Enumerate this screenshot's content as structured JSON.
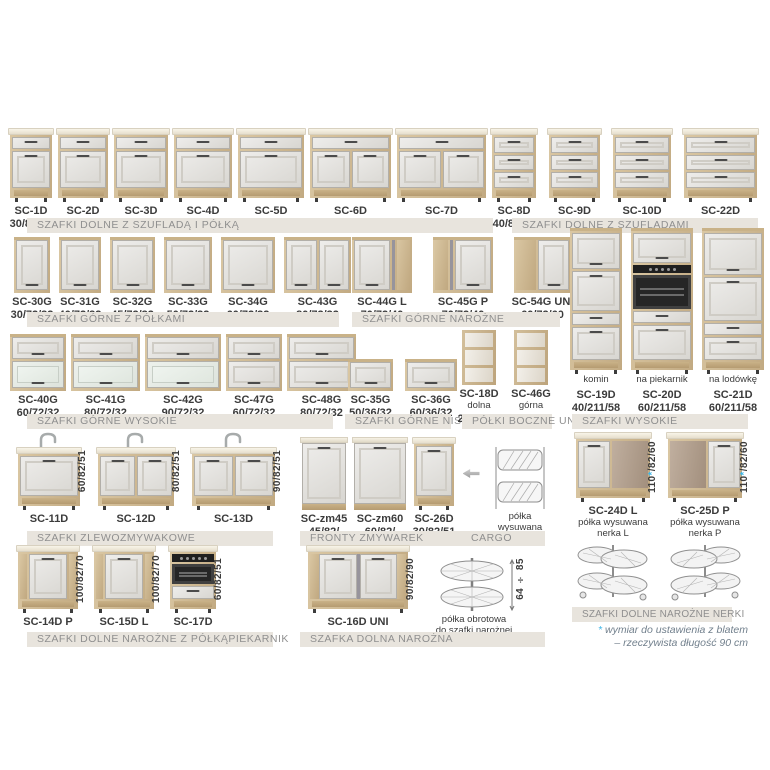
{
  "accent_color": "#3bb6e8",
  "band_bg_color": "#e8e4dd",
  "groups": [
    {
      "id": "g1",
      "band": "SZAFKI DOLNE Z SZUFLADĄ I PÓŁKĄ",
      "items": [
        {
          "code": "SC-1D",
          "dims": "30/82/51",
          "type": "base-d1"
        },
        {
          "code": "SC-2D",
          "dims": "40/82/51",
          "type": "base-d1"
        },
        {
          "code": "SC-3D",
          "dims": "45/82/51",
          "type": "base-d1"
        },
        {
          "code": "SC-4D",
          "dims": "50/82/51",
          "type": "base-d1"
        },
        {
          "code": "SC-5D",
          "dims": "60/82/51",
          "type": "base-d1"
        },
        {
          "code": "SC-6D",
          "dims": "80/82/51",
          "type": "base-d2"
        },
        {
          "code": "SC-7D",
          "dims": "90/82/51",
          "type": "base-d2"
        }
      ]
    },
    {
      "id": "g2",
      "band": "SZAFKI DOLNE Z SZUFLADAMI",
      "items": [
        {
          "code": "SC-8D",
          "dims": "40/82/51",
          "type": "base-dr3"
        },
        {
          "code": "SC-9D",
          "dims": "50/82/51",
          "type": "base-dr3"
        },
        {
          "code": "SC-10D",
          "dims": "60/82/51",
          "type": "base-dr3"
        },
        {
          "code": "SC-22D",
          "dims": "80/82/51",
          "type": "base-dr3"
        }
      ]
    },
    {
      "id": "g3",
      "band": "SZAFKI GÓRNE Z PÓŁKAMI",
      "items": [
        {
          "code": "SC-30G",
          "dims": "30/72/32",
          "type": "up-1"
        },
        {
          "code": "SC-31G",
          "dims": "40/72/32",
          "type": "up-1"
        },
        {
          "code": "SC-32G",
          "dims": "45/72/32",
          "type": "up-1"
        },
        {
          "code": "SC-33G",
          "dims": "50/72/32",
          "type": "up-1"
        },
        {
          "code": "SC-34G",
          "dims": "60/72/32",
          "type": "up-1"
        },
        {
          "code": "SC-43G",
          "dims": "80/72/32",
          "type": "up-2"
        }
      ]
    },
    {
      "id": "g4",
      "band": "SZAFKI GÓRNE NAROŻNE",
      "items": [
        {
          "code": "SC-44G L",
          "dims": "70/72/40",
          "type": "up-corner-l"
        },
        {
          "code": "SC-45G P",
          "dims": "70/72/40",
          "type": "up-corner-p"
        },
        {
          "code": "SC-54G UNI",
          "dims": "60/72/60",
          "type": "up-corner-u"
        }
      ]
    },
    {
      "id": "g5",
      "band": "SZAFKI GÓRNE WYSOKIE",
      "items": [
        {
          "code": "SC-40G",
          "dims": "60/72/32",
          "type": "flip-glass"
        },
        {
          "code": "SC-41G",
          "dims": "80/72/32",
          "type": "flip-glass"
        },
        {
          "code": "SC-42G",
          "dims": "90/72/32",
          "type": "flip-glass"
        },
        {
          "code": "SC-47G",
          "dims": "60/72/32",
          "type": "flip-solid"
        },
        {
          "code": "SC-48G",
          "dims": "80/72/32",
          "type": "flip-solid"
        }
      ]
    },
    {
      "id": "g6",
      "band": "SZAFKI GÓRNE NISKIE",
      "items": [
        {
          "code": "SC-35G",
          "dims": "50/36/32",
          "type": "low-flip"
        },
        {
          "code": "SC-36G",
          "dims": "60/36/32",
          "type": "low-flip"
        }
      ]
    },
    {
      "id": "g7",
      "band": "PÓŁKI BOCZNE UNI",
      "items": [
        {
          "code": "SC-18D",
          "sub": "dolna",
          "dims": "20/72/56",
          "type": "side-shelf"
        },
        {
          "code": "SC-46G",
          "sub": "górna",
          "dims": "20/72/30",
          "type": "side-shelf"
        }
      ]
    },
    {
      "id": "g8",
      "band": "SZAFKI WYSOKIE",
      "items": [
        {
          "sub": "komin",
          "code": "SC-19D",
          "dims": "40/211/58",
          "type": "tall-plain"
        },
        {
          "sub": "na piekarnik",
          "code": "SC-20D",
          "dims": "60/211/58",
          "type": "tall-oven"
        },
        {
          "sub": "na lodówkę",
          "code": "SC-21D",
          "dims": "60/211/58",
          "type": "tall-fridge"
        }
      ]
    },
    {
      "id": "g9",
      "band": "SZAFKI ZLEWOZMYWAKOWE",
      "items": [
        {
          "code": "SC-11D",
          "vdim": "60/82/51",
          "type": "sink-1"
        },
        {
          "code": "SC-12D",
          "vdim": "80/82/51",
          "type": "sink-2"
        },
        {
          "code": "SC-13D",
          "vdim": "90/82/51",
          "type": "sink-2"
        }
      ]
    },
    {
      "id": "g10",
      "band_left": "FRONTY ZMYWAREK",
      "band_right": "CARGO",
      "items": [
        {
          "code": "SC-zm45",
          "dims": "45/82/",
          "type": "dw-front"
        },
        {
          "code": "SC-zm60",
          "dims": "60/82/",
          "type": "dw-front"
        },
        {
          "code": "SC-26D",
          "dims": "30/82/51",
          "type": "cargo-base"
        },
        {
          "type": "arrow"
        },
        {
          "caption": "półka wysuwana",
          "type": "cargo-basket"
        }
      ]
    },
    {
      "id": "g11",
      "band": "SZAFKI DOLNE NAROŻNE NERKI",
      "note": {
        "star": "*",
        "line1": "wymiar do ustawienia z blatem",
        "line2": "– rzeczywista długość 90 cm"
      },
      "items": [
        {
          "code": "SC-24D L",
          "sub": "półka wysuwana nerka L",
          "vdim_pre": "110",
          "vdim_star": "*",
          "vdim_post": "/82/60",
          "type": "corner-blind-l"
        },
        {
          "code": "SC-25D P",
          "sub": "półka wysuwana nerka P",
          "vdim_pre": "110",
          "vdim_star": "*",
          "vdim_post": "/82/60",
          "type": "corner-blind-p"
        }
      ]
    },
    {
      "id": "g12",
      "band_left": "SZAFKI DOLNE NAROŻNE Z PÓŁKĄ",
      "band_right": "PIEKARNIK",
      "items": [
        {
          "code": "SC-14D P",
          "vdim": "100/82/70",
          "type": "corner-angled"
        },
        {
          "code": "SC-15D L",
          "vdim": "100/82/70",
          "type": "corner-angled"
        },
        {
          "code": "SC-17D",
          "vdim": "60/82/51",
          "type": "oven-base"
        }
      ]
    },
    {
      "id": "g13",
      "band": "SZAFKA DOLNA NAROŻNA",
      "items": [
        {
          "code": "SC-16D UNI",
          "vdim": "90/82/90",
          "type": "corner-uni"
        },
        {
          "caption_line1": "półka obrotowa",
          "caption_line2": "do szafki narożnej",
          "vdim": "64 ÷ 85",
          "type": "carousel"
        }
      ]
    }
  ]
}
